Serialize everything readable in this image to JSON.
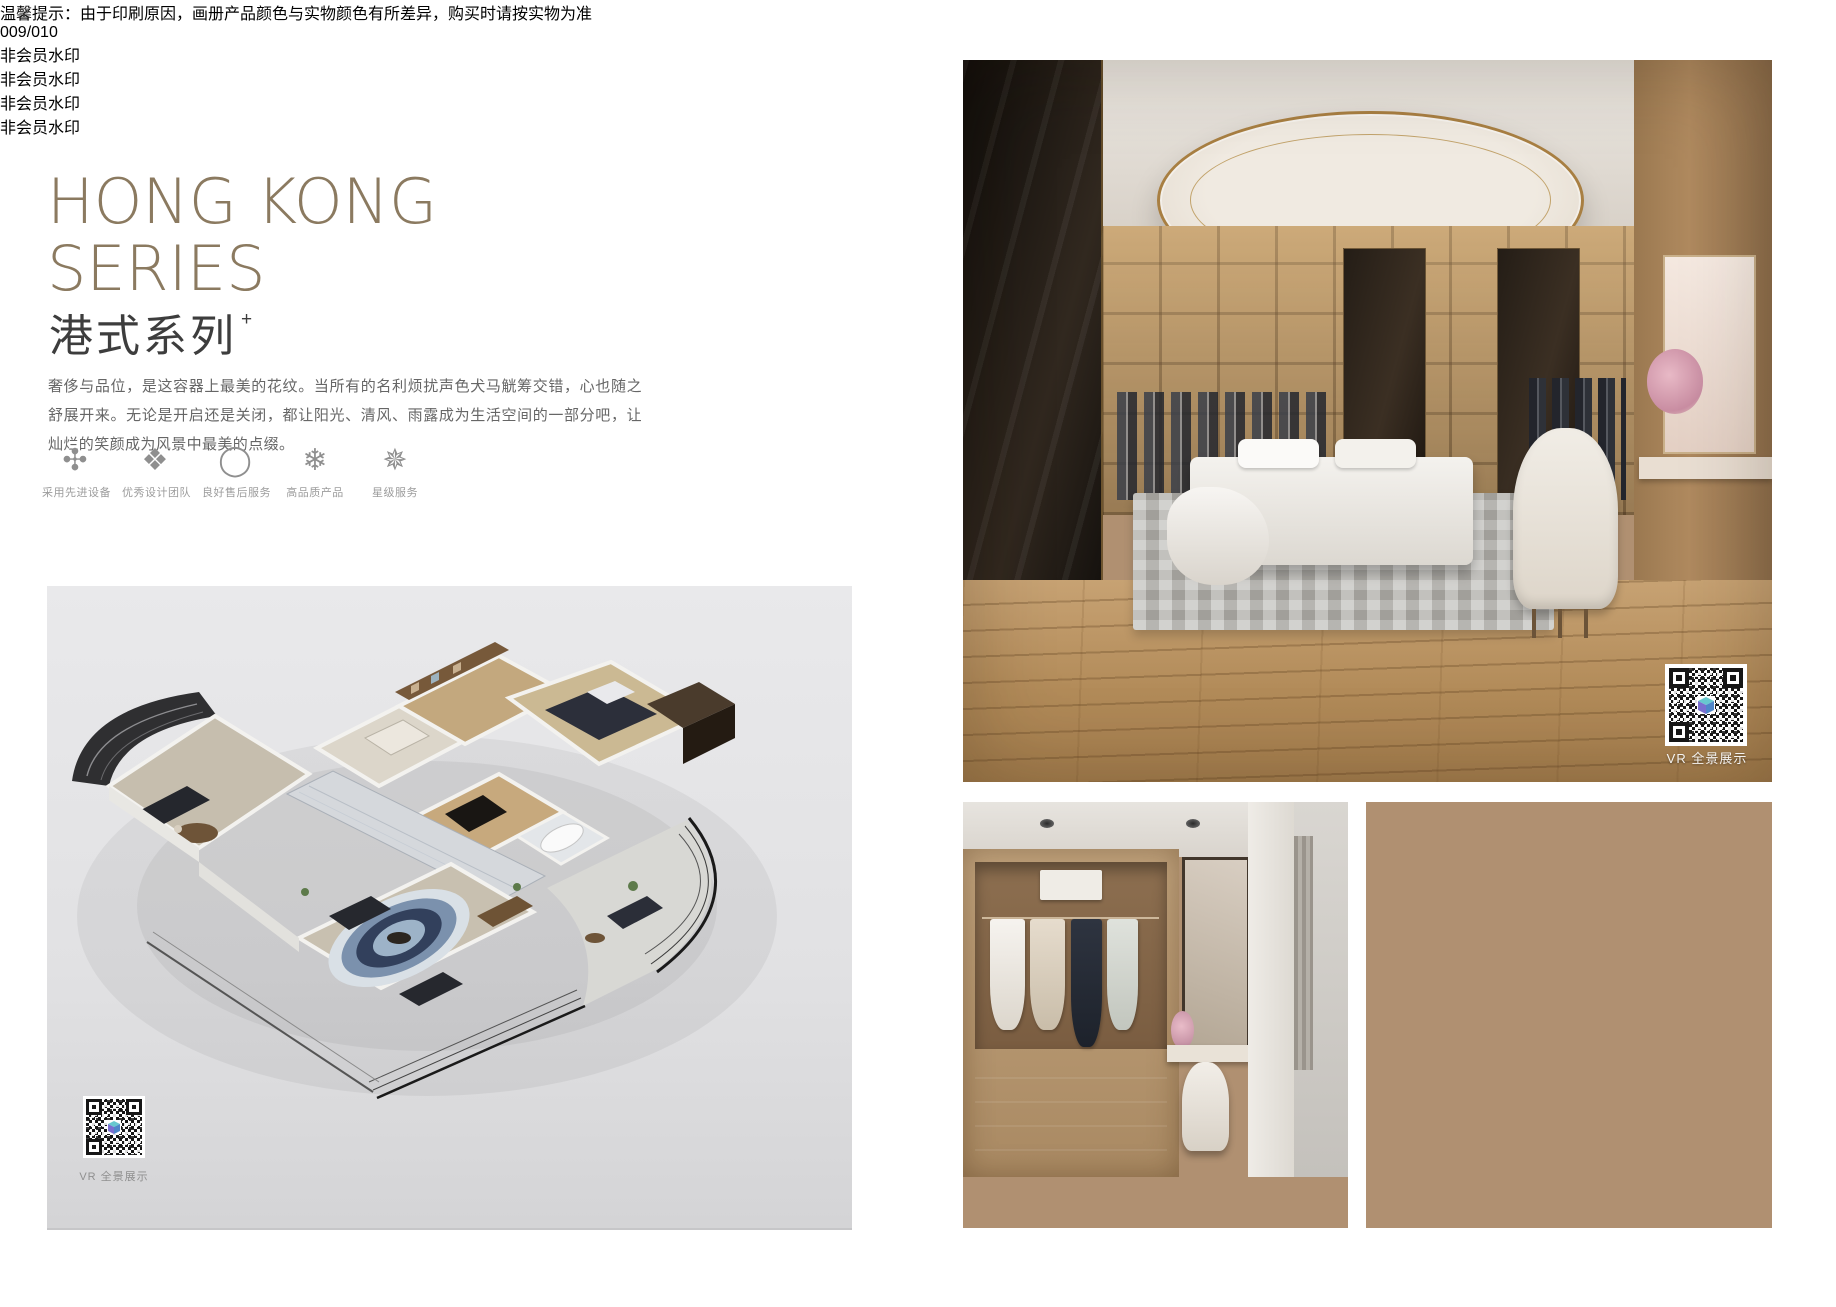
{
  "header": {
    "title_line1": "HONG KONG",
    "title_line2": "SERIES",
    "subtitle": "港式系列",
    "subtitle_superscript": "+",
    "description": "奢侈与品位，是这容器上最美的花纹。当所有的名利烦扰声色犬马觥筹交错，心也随之舒展开来。无论是开启还是关闭，都让阳光、清风、雨露成为生活空间的一部分吧，让灿烂的笑颜成为风景中最美的点缀。"
  },
  "features": [
    {
      "icon": "flower-ornament-icon",
      "glyph": "✣",
      "label": "采用先进设备"
    },
    {
      "icon": "diamond-ornament-icon",
      "glyph": "❖",
      "label": "优秀设计团队"
    },
    {
      "icon": "ring-icon",
      "glyph": "◯",
      "label": "良好售后服务"
    },
    {
      "icon": "snowflake-icon",
      "glyph": "❄",
      "label": "高品质产品"
    },
    {
      "icon": "star-ornament-icon",
      "glyph": "✵",
      "label": "星级服务"
    }
  ],
  "floorplan_panel": {
    "vr_qr_label": "VR 全景展示"
  },
  "main_photo": {
    "vr_qr_label": "VR 全景展示"
  },
  "footer": {
    "disclaimer": "温馨提示：由于印刷原因，画册产品颜色与实物颜色有所差异，购买时请按实物为准",
    "page_number": "009/010"
  },
  "watermark": {
    "text": "非会员水印"
  },
  "colors": {
    "title_bronze": "#8b7a60",
    "subtitle_dark": "#3d3d3d",
    "body_text": "#666666",
    "label_gray": "#9c9c9c",
    "panel_gray": "#e3e3e5",
    "ceiling_ring_gold": "#a87f42",
    "wood_floor": "#b28b59"
  }
}
